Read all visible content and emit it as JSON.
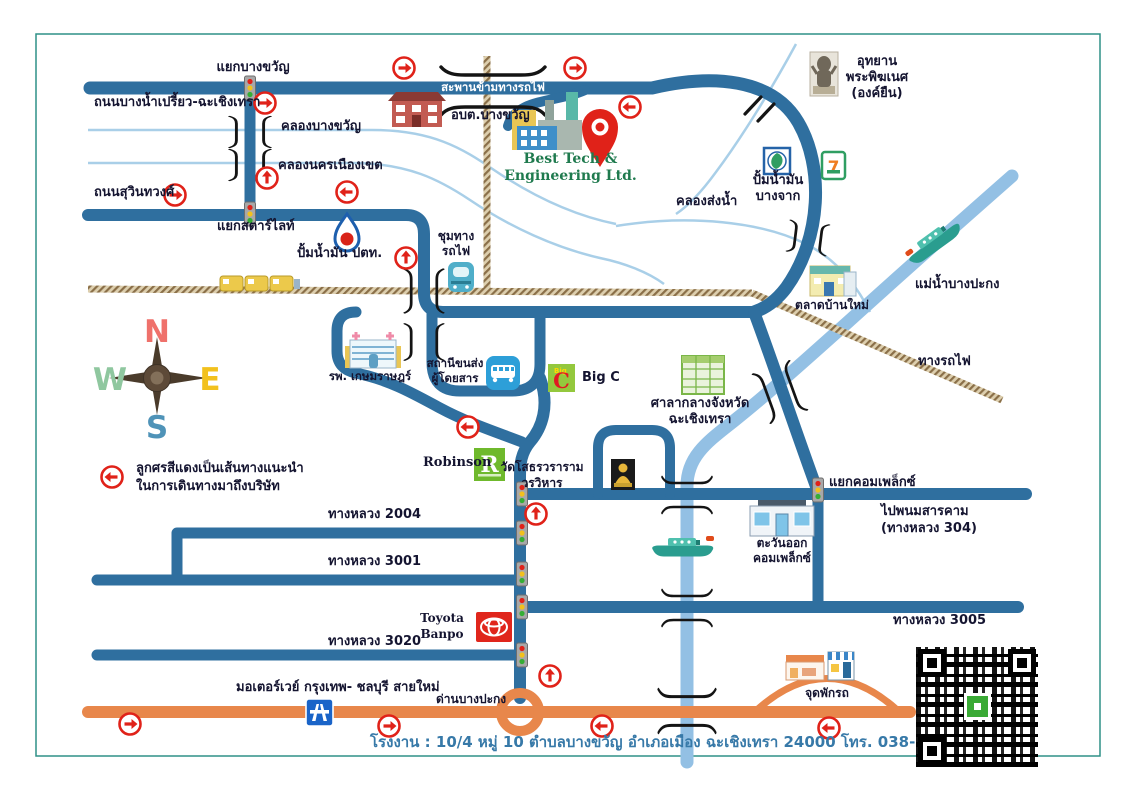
{
  "frame": {
    "address": "โรงงาน : 10/4 หมู่ 10 ตำบลบางขวัญ อำเภอเมือง ฉะเชิงเทรา 24000 โทร. 038-090-793-5"
  },
  "company": {
    "line1": "Best Tech &",
    "line2": "Engineering Ltd."
  },
  "legend": {
    "line1": "ลูกศรสีแดงเป็นเส้นทางแนะนำ",
    "line2": "ในการเดินทางมาถึงบริษัท"
  },
  "compass": {
    "n": "N",
    "e": "E",
    "w": "W",
    "s": "S"
  },
  "roads": {
    "bang_nam_priao": "ถนนบางน้ำเปรี้ยว-ฉะเชิงเทรา",
    "suwinthawong": "ถนนสุวินทวงศ์",
    "rail_bridge": "สะพานข้ามทางรถไฟ",
    "hwy_2004": "ทางหลวง 2004",
    "hwy_3001": "ทางหลวง 3001",
    "hwy_3020": "ทางหลวง 3020",
    "hwy_3005": "ทางหลวง 3005",
    "to_phanom_line1": "ไปพนมสารคาม",
    "to_phanom_line2": "(ทางหลวง 304)",
    "motorway": "มอเตอร์เวย์ กรุงเทพ- ชลบุรี สายใหม่",
    "railway": "ทางรถไฟ"
  },
  "junctions": {
    "bang_khwan": "แยกบางขวัญ",
    "starlight": "แยกสตาร์ไลท์",
    "complex": "แยกคอมเพล็กซ์",
    "rail_junction_line1": "ชุมทาง",
    "rail_junction_line2": "รถไฟ",
    "toll_gate": "ด่านบางปะกง",
    "rest_area": "จุดพักรถ"
  },
  "waterways": {
    "khlong_bang_khwan": "คลองบางขวัญ",
    "khlong_nakhon_nueang_khet": "คลองนครเนืองเขต",
    "khlong_song_nam": "คลองส่งน้ำ",
    "bang_pakong_river": "แม่น้ำบางปะกง"
  },
  "places": {
    "obt_bang_khwan": "อบต.บางขวัญ",
    "ganesh_line1": "อุทยาน",
    "ganesh_line2": "พระพิฆเนศ",
    "ganesh_line3": "(องค์ยืน)",
    "ptt_station": "ปั้มน้ำมัน ปตท.",
    "bangchak_line1": "ปั้มน้ำมัน",
    "bangchak_line2": "บางจาก",
    "talat_ban_mai": "ตลาดบ้านใหม่",
    "hospital": "รพ. เกษมราษฎร์",
    "bus_terminal_line1": "สถานีขนส่ง",
    "bus_terminal_line2": "ผู้โดยสาร",
    "big_c": "Big C",
    "city_hall_line1": "ศาลากลางจังหวัด",
    "city_hall_line2": "ฉะเชิงเทรา",
    "robinson": "Robinson",
    "wat_line1": "วัดโสธรวราราม",
    "wat_line2": "วรวิหาร",
    "tawan_ok_line1": "ตะวันออก",
    "tawan_ok_line2": "คอมเพล็กซ์",
    "toyota_line1": "Toyota",
    "toyota_line2": "Banpo"
  },
  "icons": {
    "seven_eleven": "7",
    "robinson_letter": "R",
    "big_c_letter": "C",
    "big_c_word": "Big"
  },
  "colors": {
    "road": "#2f6f9f",
    "river": "#93c0e4",
    "canal": "#a9cfe8",
    "motorway": "#e8874b",
    "route_arrow": "#e02219",
    "company_green": "#1f7a4e",
    "address_text": "#3779a8",
    "frame_border": "#2f9187",
    "railway": "#8a6f48"
  }
}
